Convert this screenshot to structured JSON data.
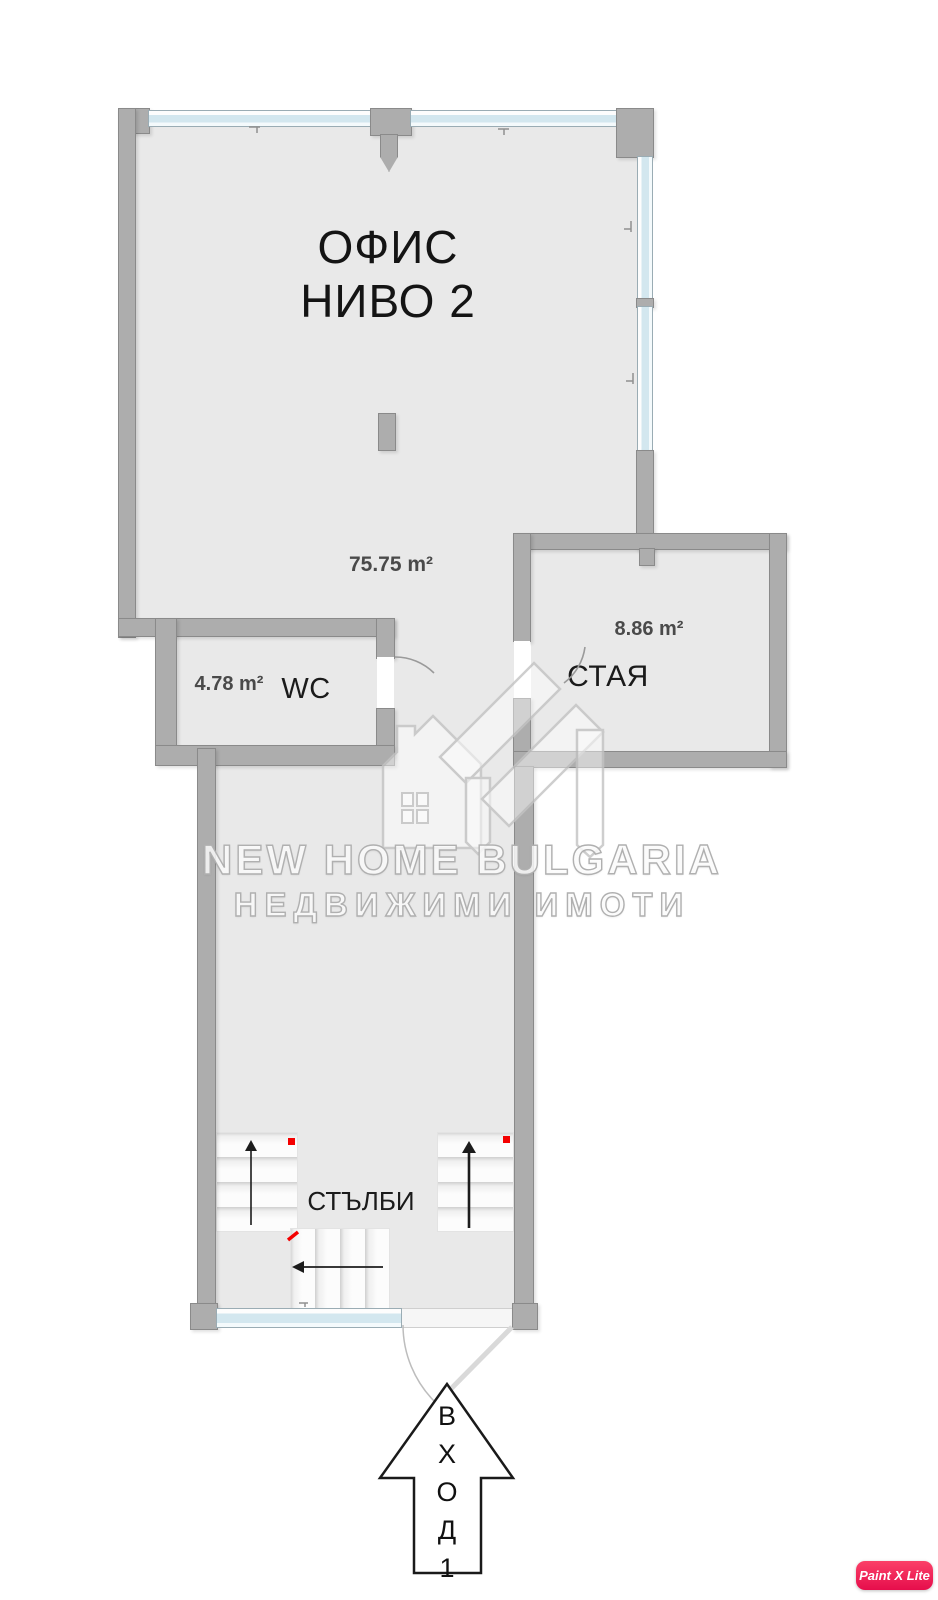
{
  "rooms": {
    "office": {
      "name_line1": "ОФИС",
      "name_line2": "НИВО 2",
      "area": "75.75 m²"
    },
    "wc": {
      "name": "WC",
      "area": "4.78 m²"
    },
    "staya": {
      "name": "СТАЯ",
      "area": "8.86 m²"
    },
    "stairs": {
      "name": "СТЪЛБИ"
    }
  },
  "entrance": {
    "label": "ВХОД 1",
    "letters": [
      "В",
      "Х",
      "О",
      "Д",
      "1"
    ]
  },
  "watermark": {
    "line1": "NEW HOME BULGARIA",
    "line2": "НЕДВИЖИМИ ИМОТИ"
  },
  "badge": {
    "label": "Paint X Lite"
  },
  "colors": {
    "wall": "#adadad",
    "floor": "#e9e9e9",
    "window_glass": "#d3e7ef",
    "marker_red": "#f40000",
    "badge_pink": "#e60d4c"
  }
}
